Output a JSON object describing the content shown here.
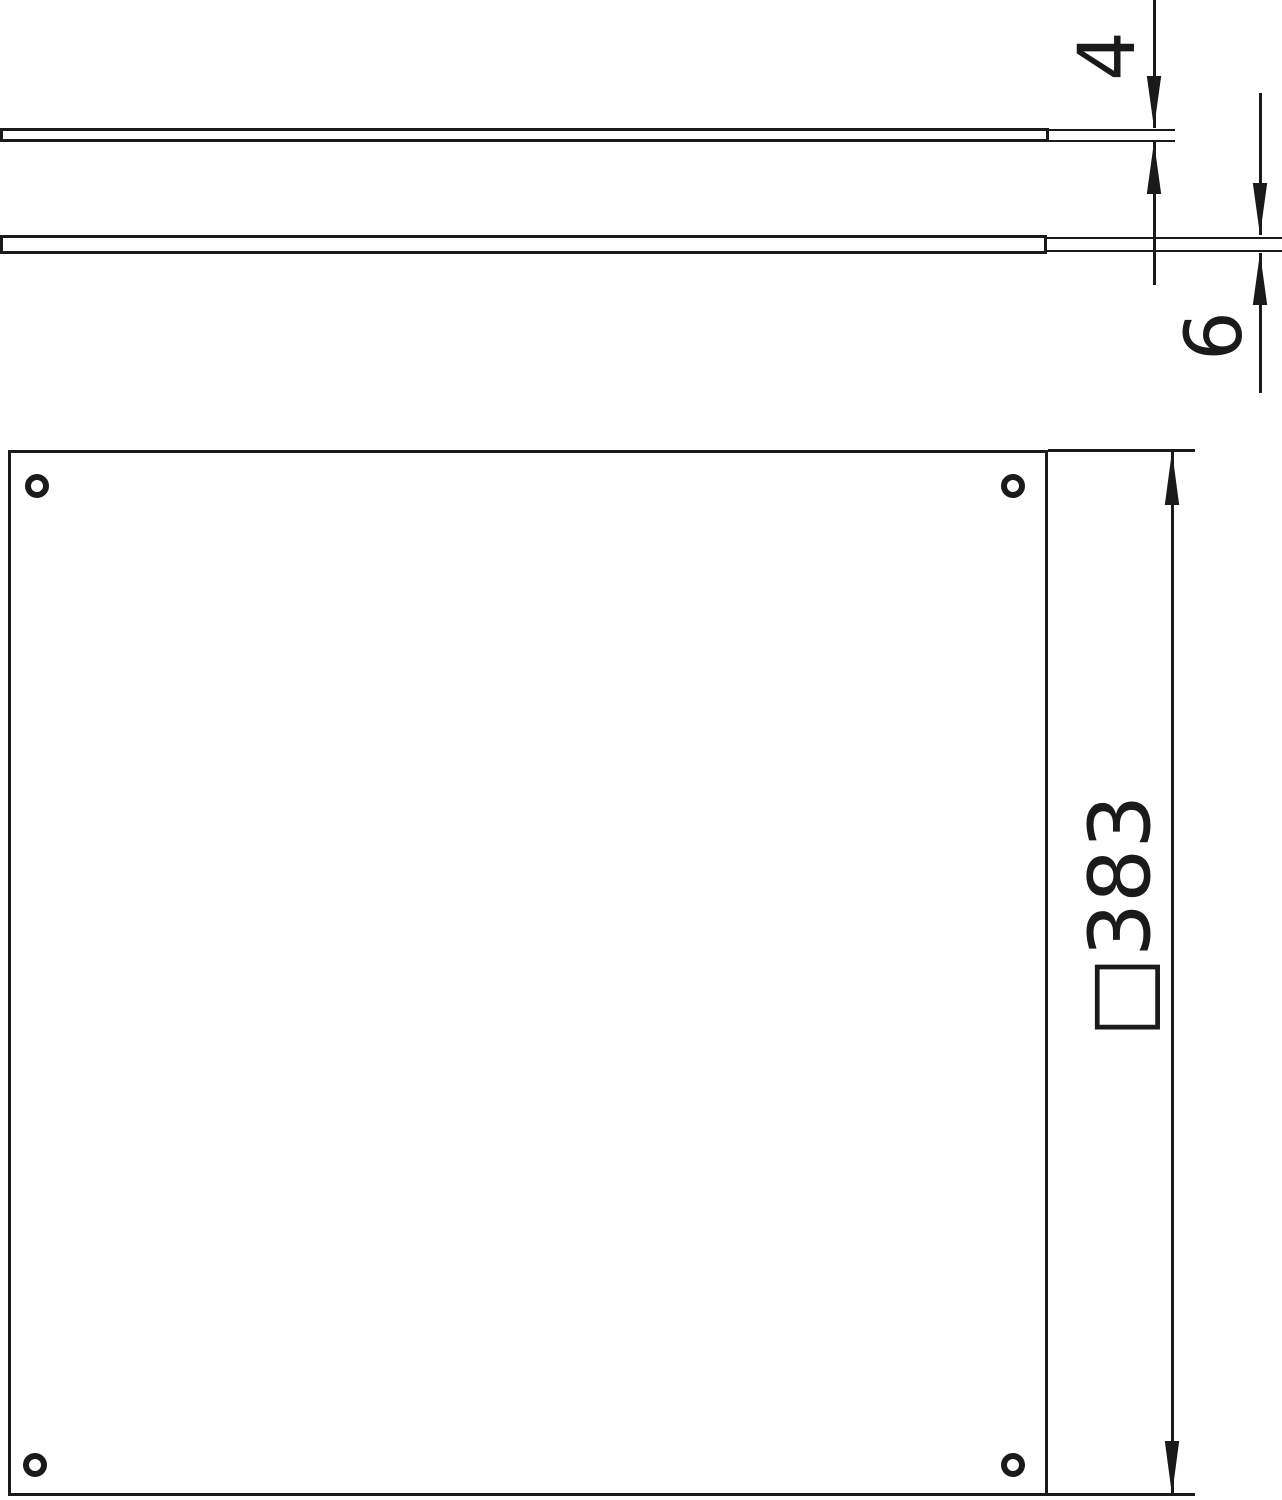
{
  "drawing": {
    "type": "technical-dimension-drawing",
    "background": "#ffffff",
    "line_color": "#1a1a1a",
    "side_view": {
      "top_plate_thickness_label": "4",
      "bottom_plate_thickness_label": "6"
    },
    "plan_view": {
      "outer_dimension_label": "□383"
    }
  }
}
